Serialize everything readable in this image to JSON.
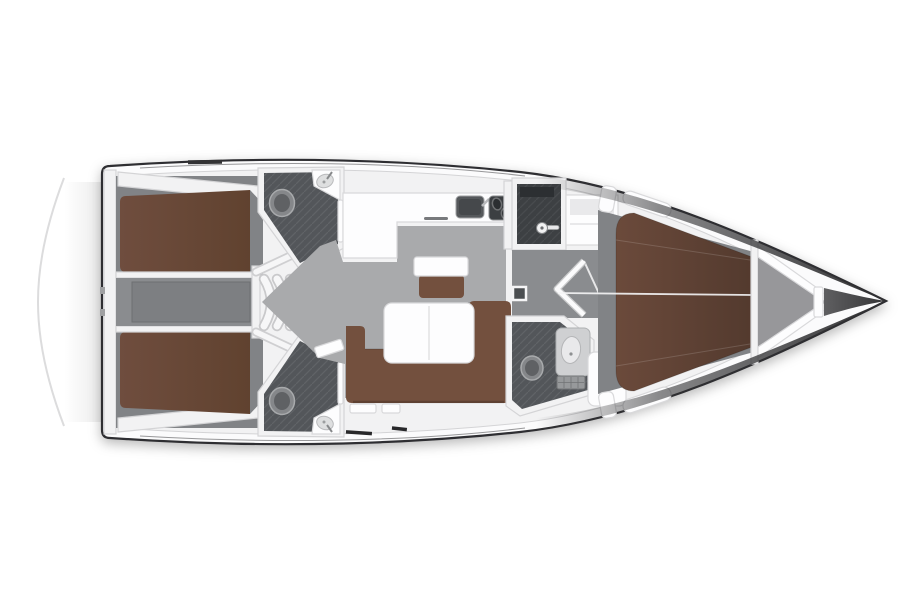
{
  "diagram": {
    "title": "Sailing yacht interior layout – top view floor plan",
    "type": "yacht-floor-plan",
    "view": "top-down",
    "orientation": {
      "bow": "right",
      "stern": "left"
    },
    "rooms": [
      {
        "id": "swim-platform",
        "label": "Stern swim platform"
      },
      {
        "id": "aft-cabin-port",
        "label": "Aft double cabin (port)",
        "furniture": [
          "double berth",
          "side shelf"
        ]
      },
      {
        "id": "aft-cabin-starboard",
        "label": "Aft double cabin (starboard)",
        "furniture": [
          "double berth",
          "side shelf"
        ]
      },
      {
        "id": "engine-corridor",
        "label": "Aft corridor / engine compartment"
      },
      {
        "id": "aft-head-port",
        "label": "Aft head (port)",
        "furniture": [
          "toilet",
          "corner washbasin",
          "door"
        ]
      },
      {
        "id": "aft-head-starboard",
        "label": "Aft head (starboard)",
        "furniture": [
          "toilet",
          "corner washbasin",
          "door"
        ]
      },
      {
        "id": "companionway",
        "label": "Companionway steps",
        "furniture": [
          "four curved steps"
        ]
      },
      {
        "id": "galley",
        "label": "L-shaped galley",
        "furniture": [
          "sink",
          "two-burner stove",
          "counter"
        ]
      },
      {
        "id": "nav-station",
        "label": "Navigation station",
        "furniture": [
          "chart table",
          "stool"
        ]
      },
      {
        "id": "salon",
        "label": "Salon",
        "furniture": [
          "folding dining table",
          "L-shaped sofa",
          "lockers"
        ]
      },
      {
        "id": "shower-room",
        "label": "Separate shower compartment",
        "furniture": [
          "shower head"
        ]
      },
      {
        "id": "wardrobe",
        "label": "Wardrobe locker"
      },
      {
        "id": "forward-corridor",
        "label": "Passage to forward cabin",
        "furniture": [
          "door"
        ]
      },
      {
        "id": "forward-head",
        "label": "Forward head",
        "furniture": [
          "toilet",
          "washbasin",
          "shower grate"
        ]
      },
      {
        "id": "forward-cabin",
        "label": "Forward master cabin",
        "furniture": [
          "V-berth",
          "side shelves"
        ]
      },
      {
        "id": "anchor-locker",
        "label": "Anchor locker"
      }
    ],
    "colors": {
      "background": "#ffffff",
      "hull_line": "#2e2e30",
      "deck_white": "#fbfbfc",
      "wall_white": "#f2f2f3",
      "wall_edge": "#d4d4d6",
      "floor_gray": "#a9aaac",
      "floor_dark": "#818386",
      "corridor_gray": "#8a8c8f",
      "wet_floor": "#53565a",
      "shower_floor": "#3d4043",
      "berth_brown": "#6b4a3b",
      "berth_brown_dark": "#533a2e",
      "sofa_brown": "#73503e",
      "furniture_white": "#fdfdfe",
      "furniture_edge": "#d9d9db",
      "fixture_gray": "#cfd0d2",
      "bow_dark": "#323234"
    }
  }
}
